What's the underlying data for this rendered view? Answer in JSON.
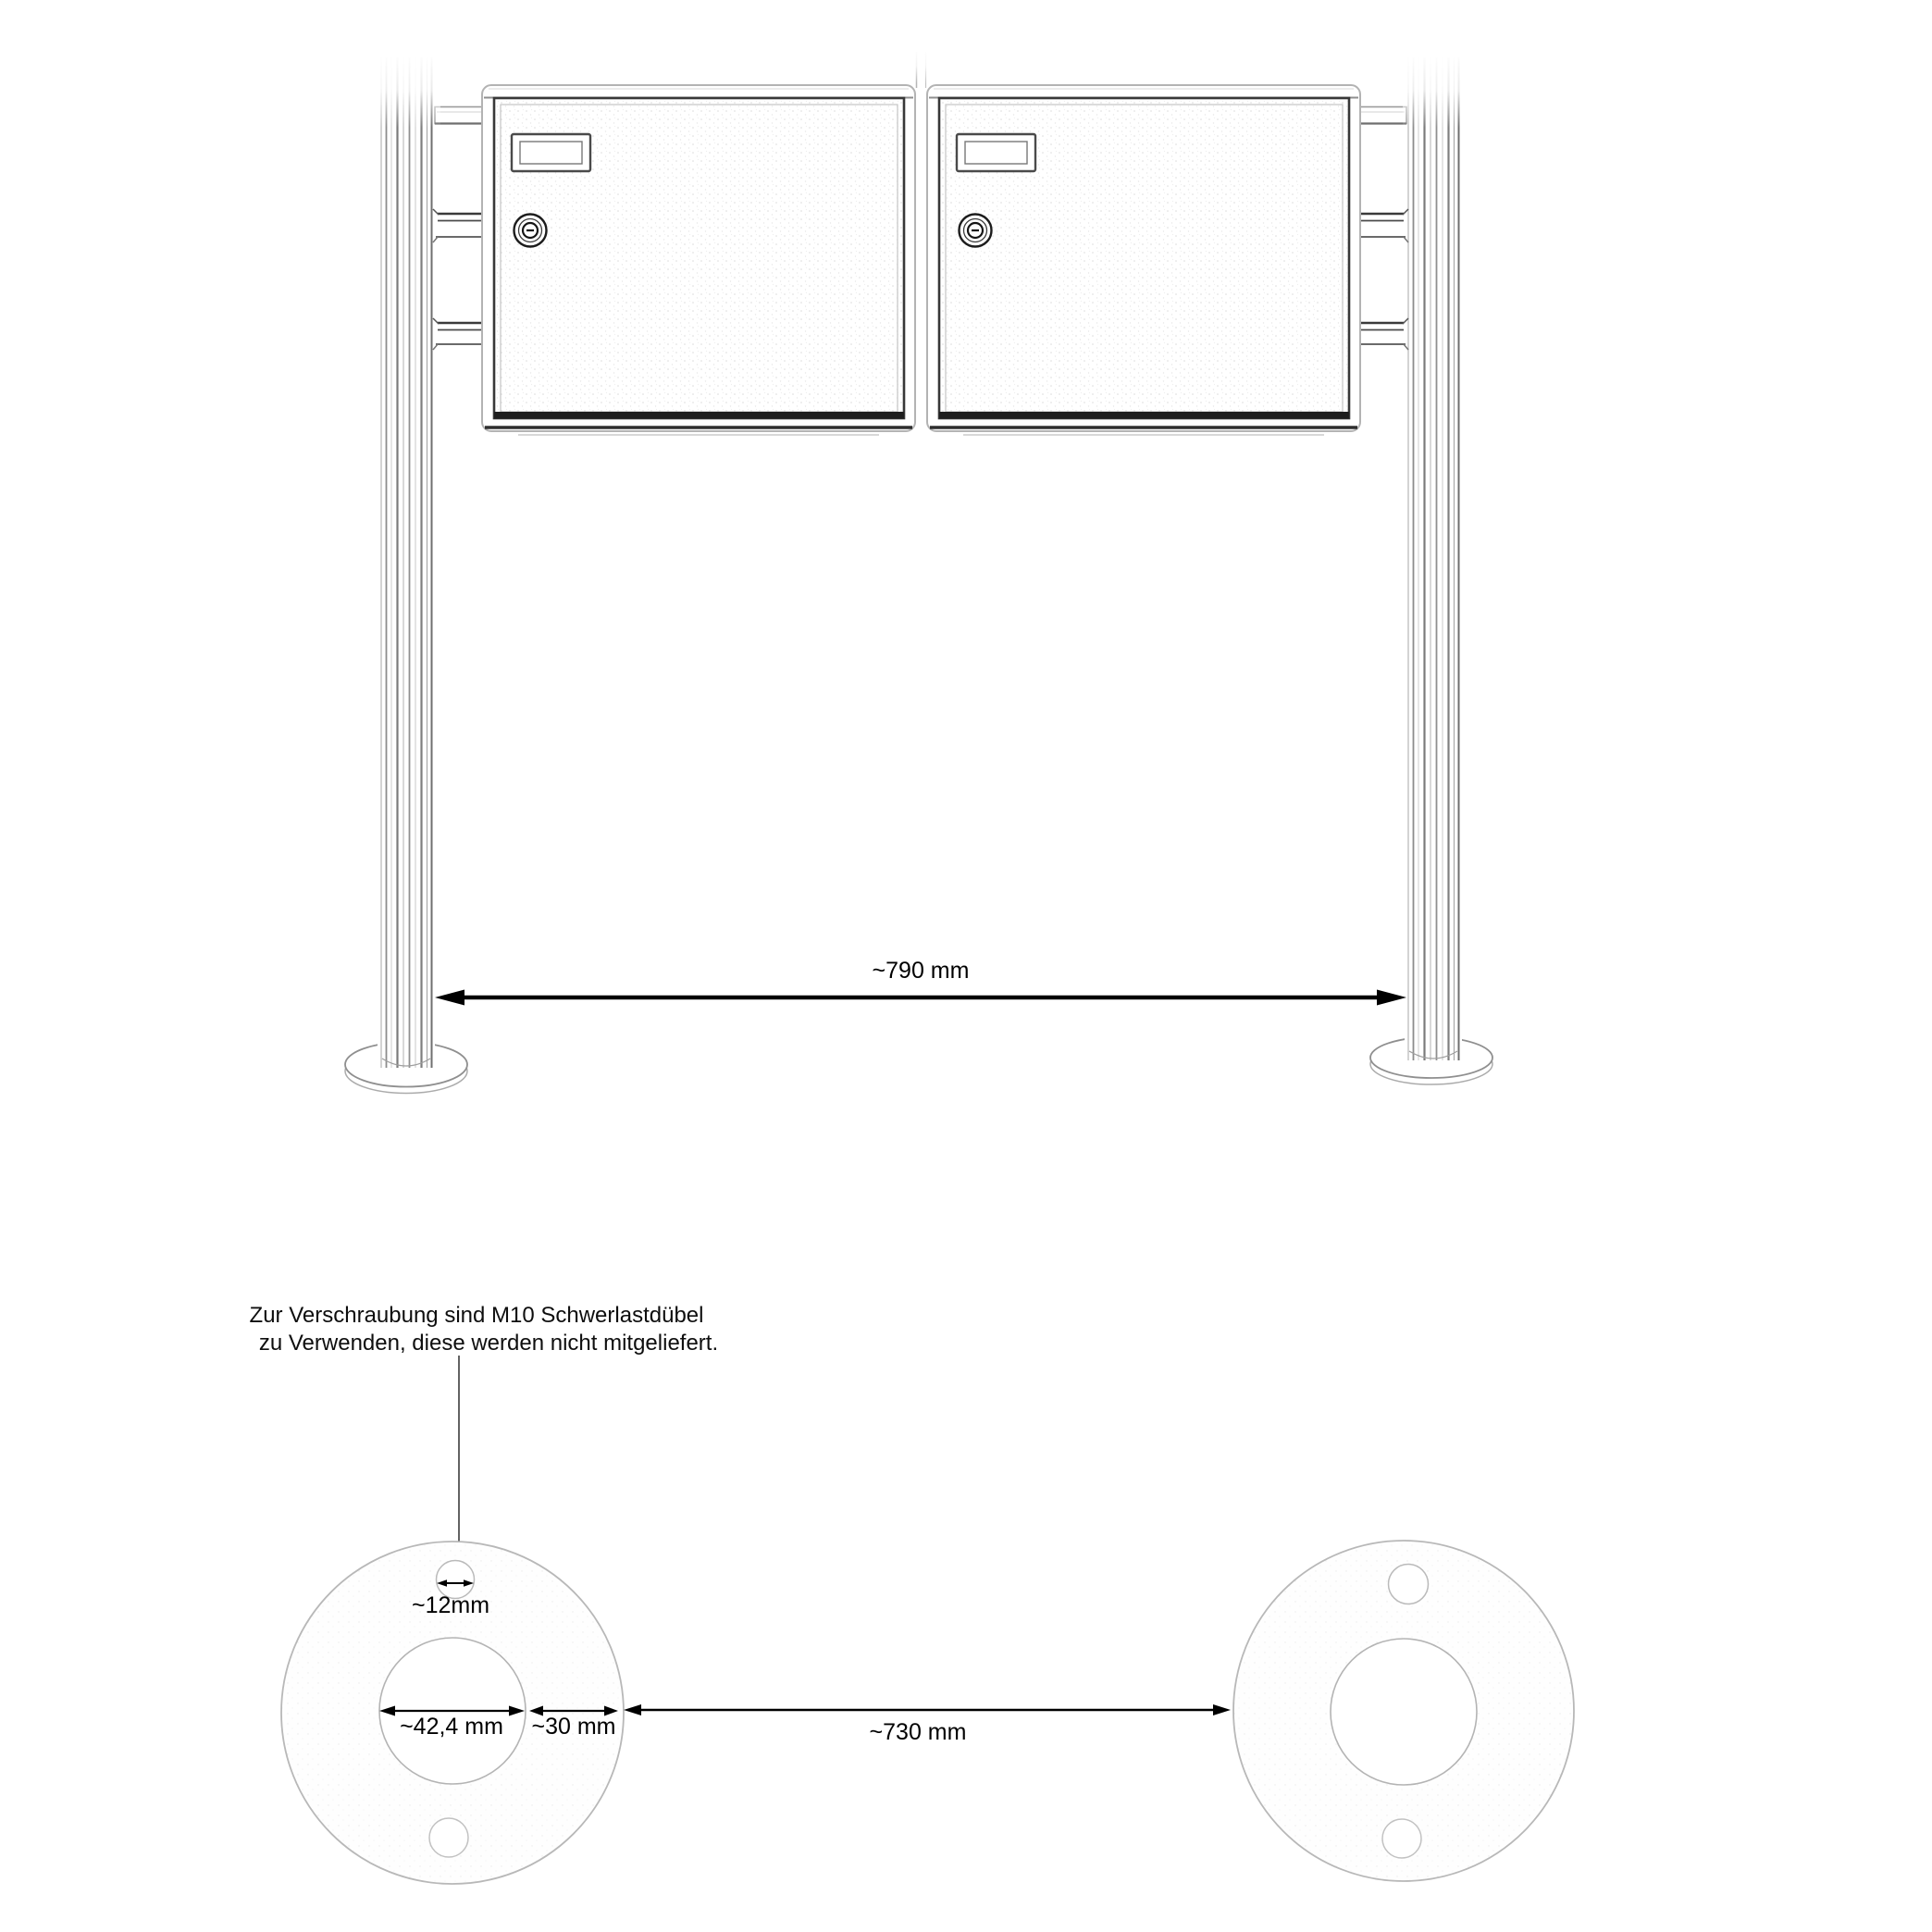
{
  "diagram": {
    "type": "technical-installation-drawing",
    "subject": "free-standing double letterbox on two round posts with ground anchor flanges",
    "note": {
      "line1": "Zur Verschraubung sind M10 Schwerlastdübel",
      "line2": "zu Verwenden, diese werden nicht mitgeliefert."
    },
    "dimensions": {
      "post_clearance": "~790 mm",
      "anchor_hole_diameter": "~12mm",
      "flange_inner_diameter": "~42,4 mm",
      "flange_ring_width": "~30 mm",
      "flange_clearance": "~730 mm"
    },
    "colors": {
      "background": "#ffffff",
      "dimension_line": "#000000",
      "drawing_soft": "#8f8f8f",
      "drawing_light": "#bdbdbd"
    }
  }
}
